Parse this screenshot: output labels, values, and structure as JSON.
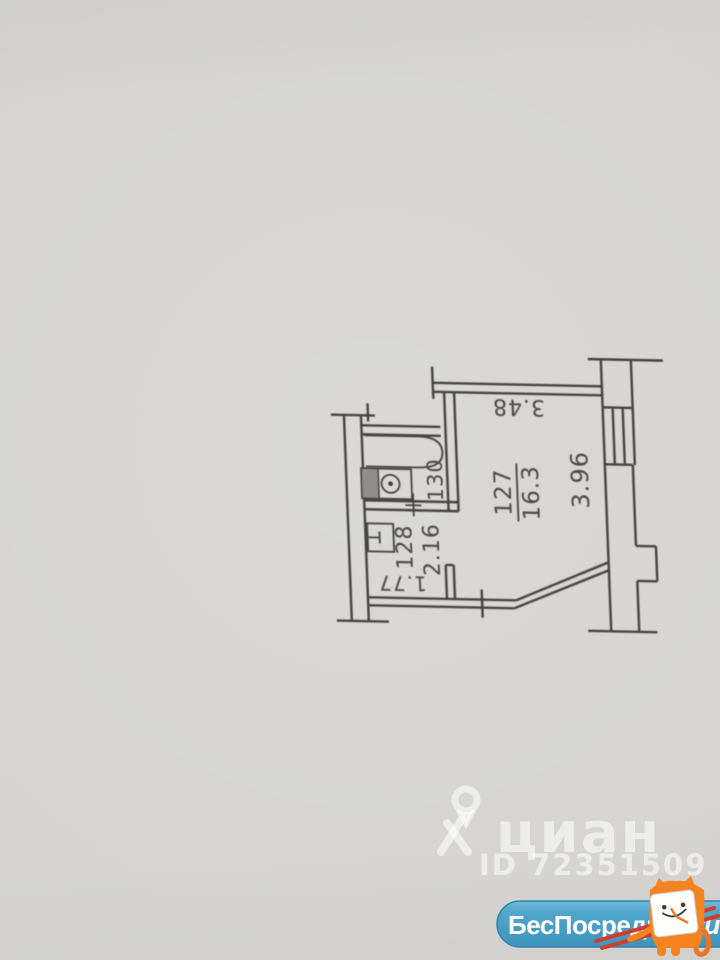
{
  "photo": {
    "paper_color": "#d4d3d0",
    "ink_color": "#45433f"
  },
  "floor_plan": {
    "labels": {
      "dim_top": "3.48",
      "room_number": "127",
      "room_area": "16.3",
      "dim_right": "3.96",
      "bathroom_number": "130",
      "hall_number": "128",
      "hall_area": "2.16",
      "dim_hall": "1.77"
    }
  },
  "watermark": {
    "brand": "циан",
    "listing_id": "ID 72351509",
    "icon": "cian-person-pin-icon",
    "color": "#ffffff"
  },
  "badge": {
    "site_name": "БесПосредника",
    "domain": ".ru",
    "mascot_icon": "cat-clock-mascot-icon",
    "pill_color": "#4da2c8",
    "mascot_orange": "#f5831f",
    "stick_red": "#d23b2e"
  }
}
